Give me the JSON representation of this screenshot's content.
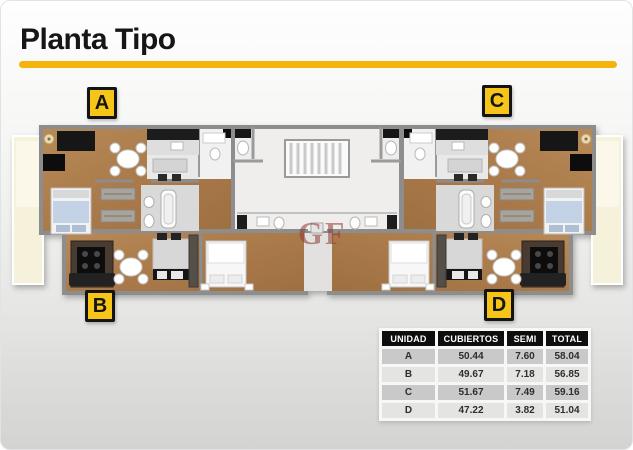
{
  "page": {
    "title": "Planta Tipo"
  },
  "colors": {
    "accent_yellow": "#F5B40B",
    "label_yellow": "#F6C517",
    "wood_floor": "#AC7B4E",
    "wall_gray": "#8D8D8D",
    "balcony_cream": "#F6F1DA",
    "watermark_red": "#8C3A30"
  },
  "floor_plan": {
    "watermark": "GF",
    "unit_labels": [
      {
        "id": "A",
        "label": "A"
      },
      {
        "id": "B",
        "label": "B"
      },
      {
        "id": "C",
        "label": "C"
      },
      {
        "id": "D",
        "label": "D"
      }
    ]
  },
  "area_table": {
    "headers": [
      "UNIDAD",
      "CUBIERTOS",
      "SEMI",
      "TOTAL"
    ],
    "rows": [
      {
        "unidad": "A",
        "cubiertos": "50.44",
        "semi": "7.60",
        "total": "58.04"
      },
      {
        "unidad": "B",
        "cubiertos": "49.67",
        "semi": "7.18",
        "total": "56.85"
      },
      {
        "unidad": "C",
        "cubiertos": "51.67",
        "semi": "7.49",
        "total": "59.16"
      },
      {
        "unidad": "D",
        "cubiertos": "47.22",
        "semi": "3.82",
        "total": "51.04"
      }
    ]
  }
}
